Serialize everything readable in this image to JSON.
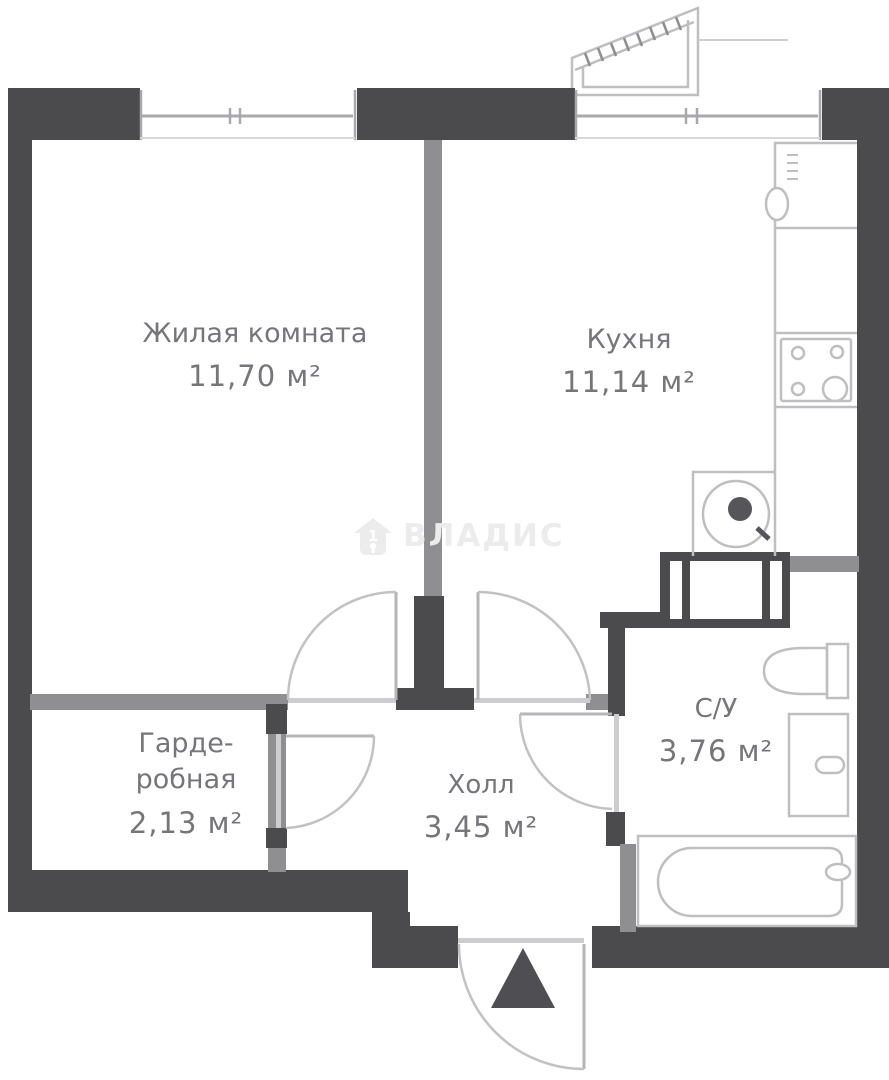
{
  "watermark": {
    "brand": "ВЛАДИС",
    "icon": "house-1-keyhole-icon",
    "icon_digit": "1"
  },
  "rooms": {
    "living": {
      "name": "Жилая комната",
      "area": "11,70 м²"
    },
    "kitchen": {
      "name": "Кухня",
      "area": "11,14 м²"
    },
    "wardrobe": {
      "name": "Гарде-робная",
      "area": "2,13 м²"
    },
    "hall": {
      "name": "Холл",
      "area": "3,45 м²"
    },
    "bathroom": {
      "name": "С/У",
      "area": "3,76 м²"
    }
  },
  "colors": {
    "outer_wall": "#4b4b4e",
    "inner_wall": "#8f8f92",
    "threshold": "#cdcdd0",
    "fixture_line": "#bfbfc2",
    "label_text": "#76767a",
    "watermark": "#ececec"
  }
}
